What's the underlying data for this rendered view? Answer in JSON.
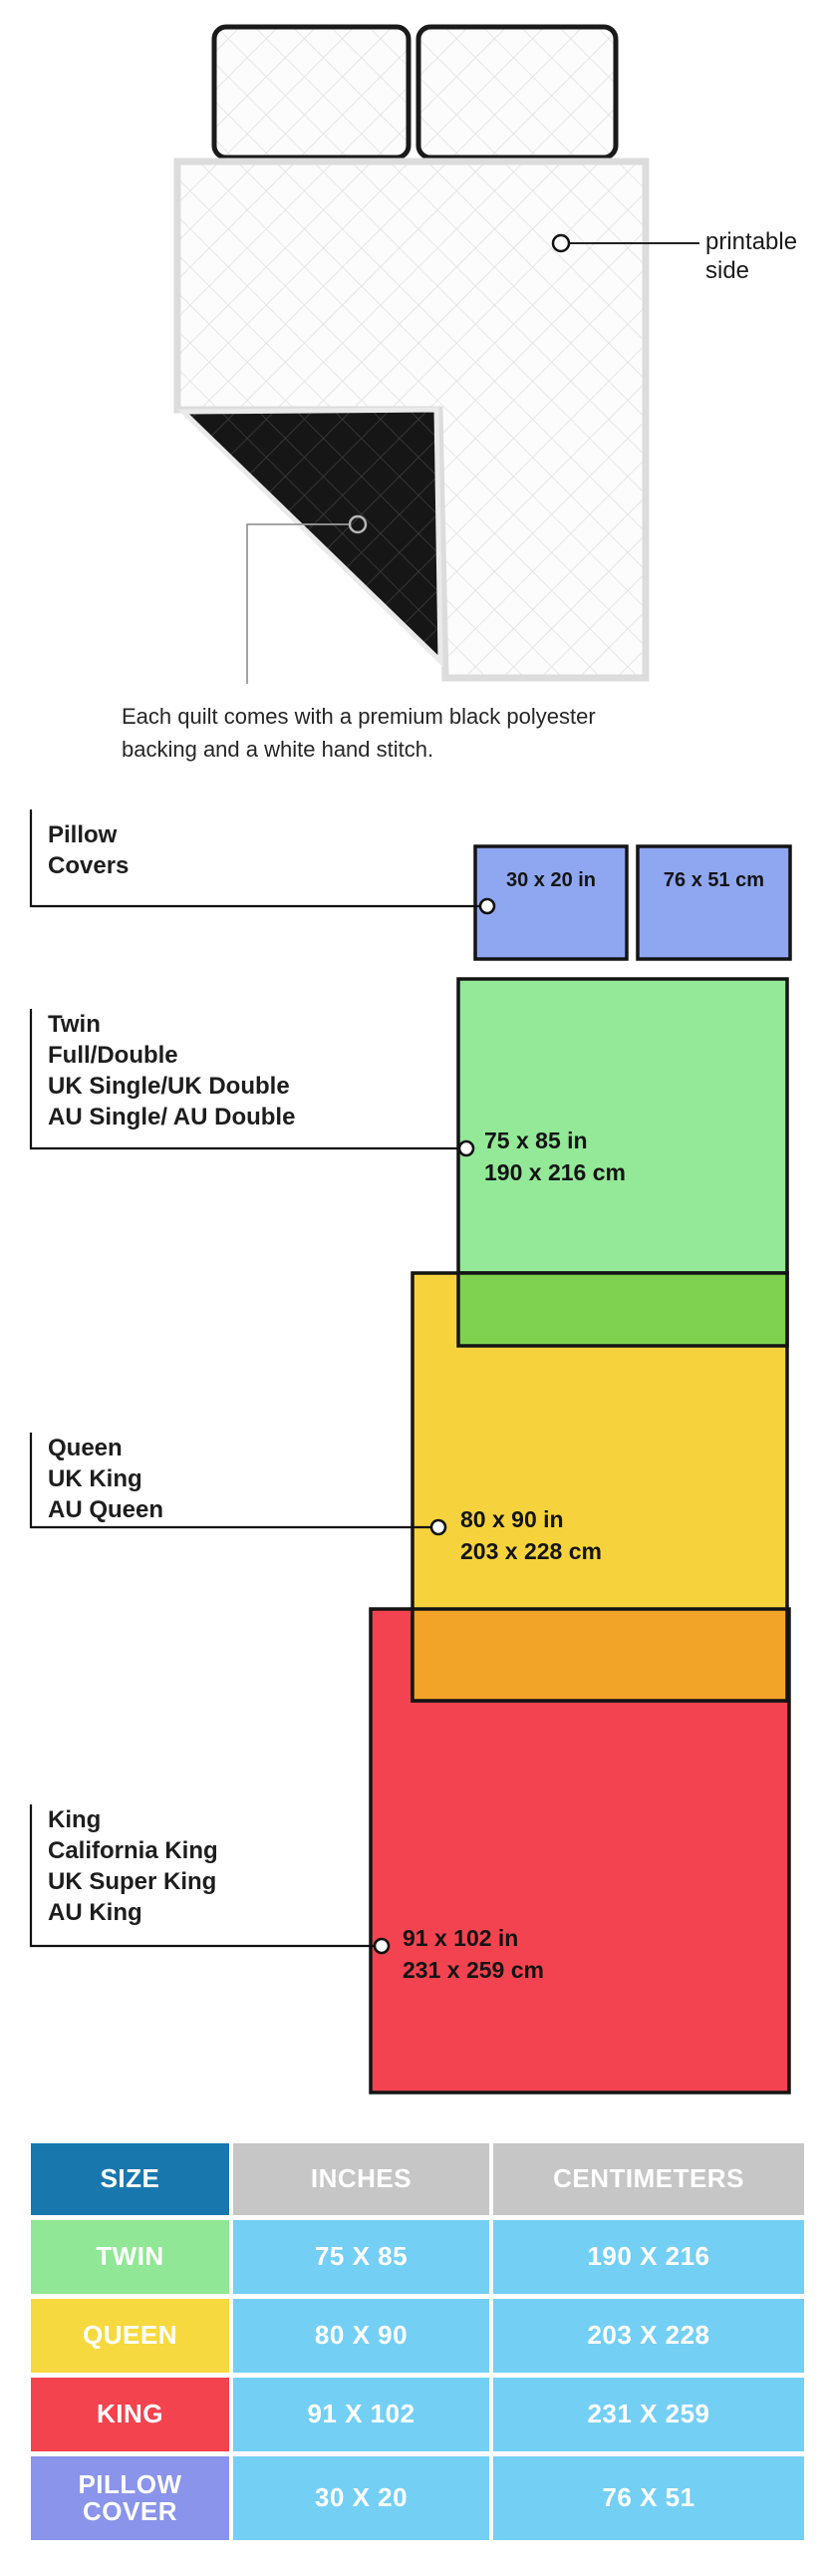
{
  "illustration": {
    "printable_label_line1": "printable",
    "printable_label_line2": "side",
    "caption_line1": "Each quilt comes with a premium black polyester",
    "caption_line2": "backing and a white hand stitch."
  },
  "diagram": {
    "pillow_covers": {
      "label_line1": "Pillow",
      "label_line2": "Covers",
      "inch_label": "30 x 20 in",
      "cm_label": "76 x 51 cm",
      "color": "#8FA7F0"
    },
    "twin": {
      "label_lines": [
        "Twin",
        "Full/Double",
        "UK Single/UK Double",
        "AU Single/ AU Double"
      ],
      "size_in": "75 x 85 in",
      "size_cm": "190 x 216 cm",
      "color": "#93E997",
      "overlap_color": "#7ED24F"
    },
    "queen": {
      "label_lines": [
        "Queen",
        "UK King",
        "AU Queen"
      ],
      "size_in": "80 x 90 in",
      "size_cm": "203 x 228 cm",
      "color": "#F6D33D",
      "overlap_color": "#F2A428"
    },
    "king": {
      "label_lines": [
        "King",
        "California King",
        "UK Super King",
        "AU King"
      ],
      "size_in": "91 x 102 in",
      "size_cm": "231 x 259 cm",
      "color": "#F44350"
    }
  },
  "table": {
    "headers": [
      "SIZE",
      "INCHES",
      "CENTIMETERS"
    ],
    "header_size_bg": "#1878AE",
    "header_gray_bg": "#C6C6C6",
    "value_bg": "#74CFF5",
    "rows": [
      {
        "size": "TWIN",
        "inches": "75 X 85",
        "cm": "190 X 216",
        "color": "#90E795"
      },
      {
        "size": "QUEEN",
        "inches": "80 X 90",
        "cm": "203 X 228",
        "color": "#F6D93E"
      },
      {
        "size": "KING",
        "inches": "91 X 102",
        "cm": "231 X 259",
        "color": "#F2434F"
      },
      {
        "size": "PILLOW COVER",
        "inches": "30 X 20",
        "cm": "76 X 51",
        "color": "#8A94EA"
      }
    ]
  }
}
